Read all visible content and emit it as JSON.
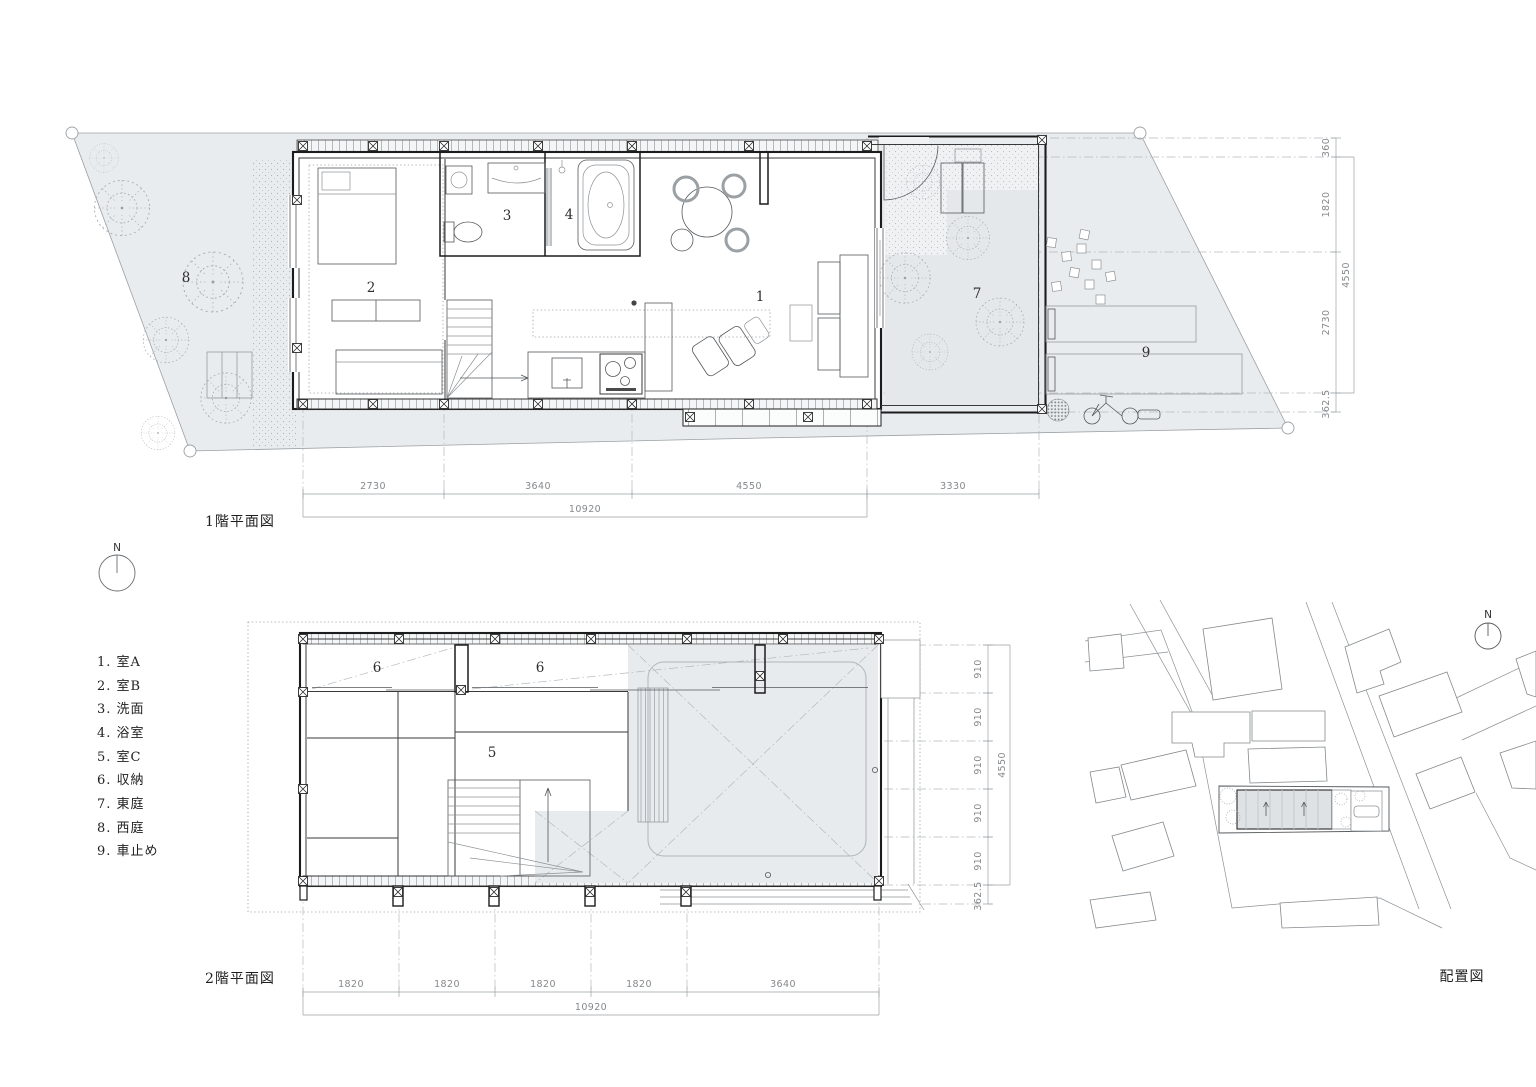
{
  "titles": {
    "floor1": "1階平面図",
    "floor2": "2階平面図",
    "site": "配置図"
  },
  "north_label": "N",
  "legend": {
    "items": [
      "1. 室A",
      "2. 室B",
      "3. 洗面",
      "4. 浴室",
      "5. 室C",
      "6. 収納",
      "7. 東庭",
      "8. 西庭",
      "9. 車止め"
    ]
  },
  "floor1": {
    "rooms": {
      "living": "1",
      "bedroom": "2",
      "washroom": "3",
      "bath": "4",
      "east_garden": "7",
      "west_garden": "8",
      "car_stop": "9"
    },
    "dims_bottom": {
      "segments": [
        "2730",
        "3640",
        "4550",
        "3330"
      ],
      "total": "10920"
    },
    "dims_right": {
      "segments": [
        "360",
        "1820",
        "2730",
        "362.5"
      ],
      "overall": "4550"
    }
  },
  "floor2": {
    "rooms": {
      "closet_a": "6",
      "closet_b": "6",
      "room_c": "5"
    },
    "dims_bottom": {
      "segments": [
        "1820",
        "1820",
        "1820",
        "1820",
        "3640"
      ],
      "total": "10920"
    },
    "dims_right": {
      "segments": [
        "910",
        "910",
        "910",
        "910",
        "910"
      ],
      "overall": "4550",
      "offset": "362.5"
    }
  },
  "colors": {
    "site_fill": "#e9ecee",
    "terrace_fill": "#e7ebee",
    "wall": "#1c1c1c",
    "dim_text": "#85898d"
  }
}
